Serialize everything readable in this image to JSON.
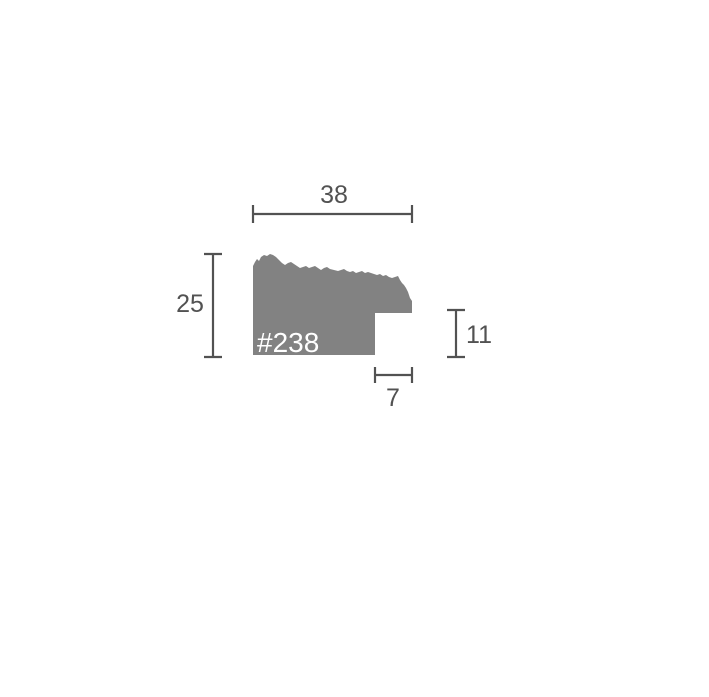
{
  "diagram": {
    "profile_label": "#238",
    "dimensions": {
      "top_width": "38",
      "left_height": "25",
      "right_step_height": "11",
      "bottom_step_width": "7"
    },
    "colors": {
      "profile_fill": "#828282",
      "dimension_line": "#525252",
      "label_text": "#ffffff",
      "background": "#ffffff"
    }
  }
}
